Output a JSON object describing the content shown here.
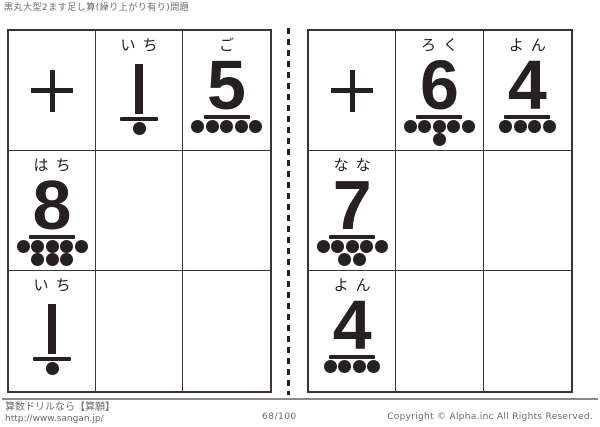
{
  "title": "黒丸大型2ます足し算(繰り上がり有り)問題",
  "plus_symbol": "+",
  "tables": [
    {
      "id": "left",
      "rows": [
        [
          {
            "type": "plus"
          },
          {
            "type": "number",
            "reading": "いち",
            "value": "1",
            "dot_rows": [
              1
            ]
          },
          {
            "type": "number",
            "reading": "ご",
            "value": "5",
            "dot_rows": [
              5
            ]
          }
        ],
        [
          {
            "type": "number",
            "reading": "はち",
            "value": "8",
            "dot_rows": [
              5,
              3
            ]
          },
          {
            "type": "empty"
          },
          {
            "type": "empty"
          }
        ],
        [
          {
            "type": "number",
            "reading": "いち",
            "value": "1",
            "dot_rows": [
              1
            ]
          },
          {
            "type": "empty"
          },
          {
            "type": "empty"
          }
        ]
      ]
    },
    {
      "id": "right",
      "rows": [
        [
          {
            "type": "plus"
          },
          {
            "type": "number",
            "reading": "ろく",
            "value": "6",
            "dot_rows": [
              5,
              1
            ]
          },
          {
            "type": "number",
            "reading": "よん",
            "value": "4",
            "dot_rows": [
              4
            ]
          }
        ],
        [
          {
            "type": "number",
            "reading": "なな",
            "value": "7",
            "dot_rows": [
              5,
              2
            ]
          },
          {
            "type": "empty"
          },
          {
            "type": "empty"
          }
        ],
        [
          {
            "type": "number",
            "reading": "よん",
            "value": "4",
            "dot_rows": [
              4
            ]
          },
          {
            "type": "empty"
          },
          {
            "type": "empty"
          }
        ]
      ]
    }
  ],
  "footer": {
    "site_label": "算数ドリルなら【算願】",
    "site_url": "http://www.sangan.jp/",
    "page_indicator": "68/100",
    "copyright": "Copyright © Alpha.inc All Rights Reserved."
  },
  "colors": {
    "ink": "#272022",
    "grid_border": "#3b3335",
    "muted_text": "#6f6a68"
  }
}
